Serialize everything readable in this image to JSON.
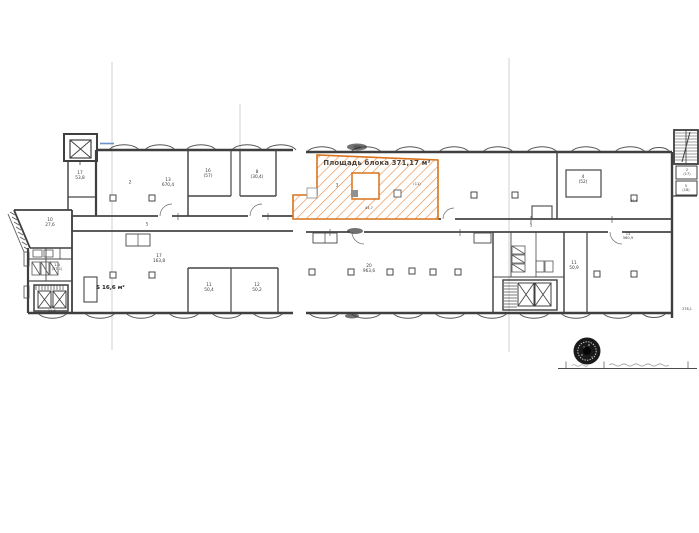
{
  "document": {
    "kind": "scanned floor plan sheet",
    "highlight_block": {
      "label": "Площадь блока 371,17 м²"
    },
    "annotations": {
      "s_area_label": "S 16,6 м²"
    }
  },
  "colors": {
    "wall_gray": "#3f3f3f",
    "highlight_border_orange": "#d9731c",
    "hatch_orange": "#e8853a",
    "crease_gray": "#d0d0d0",
    "blue_mark": "#6a93cc",
    "stamp_black": "#1a1a1a"
  },
  "icons": {
    "elevator_shaft": "x-box",
    "staircase": "step-hatch",
    "toilet_stall": "small-x-box",
    "column": "square-marker",
    "seal": "round-ink-stamp"
  },
  "rooms": [
    {
      "x": 80,
      "y": 177,
      "text": "17\n53,8"
    },
    {
      "x": 50,
      "y": 224,
      "text": "10\n27,6"
    },
    {
      "x": 57,
      "y": 267,
      "text": "1-4\n(57,1)",
      "size": 3.6
    },
    {
      "x": 52,
      "y": 309,
      "text": "1\n21,5",
      "size": 3.6
    },
    {
      "x": 130,
      "y": 184,
      "text": "2"
    },
    {
      "x": 168,
      "y": 184,
      "text": "13\n670,4"
    },
    {
      "x": 208,
      "y": 175,
      "text": "16\n(57)"
    },
    {
      "x": 257,
      "y": 176,
      "text": "8\n(30,4)"
    },
    {
      "x": 147,
      "y": 225,
      "text": "5",
      "size": 4
    },
    {
      "x": 159,
      "y": 260,
      "text": "17\n163,8"
    },
    {
      "x": 209,
      "y": 289,
      "text": "11\n50,4"
    },
    {
      "x": 257,
      "y": 289,
      "text": "12\n50,2"
    },
    {
      "x": 369,
      "y": 270,
      "text": "20\n963,6"
    },
    {
      "x": 531,
      "y": 226,
      "text": "5",
      "size": 4
    },
    {
      "x": 574,
      "y": 267,
      "text": "11\n50,9"
    },
    {
      "x": 628,
      "y": 236,
      "text": "13\n560,9",
      "size": 3.6
    },
    {
      "x": 583,
      "y": 181,
      "text": "4\n(52)"
    },
    {
      "x": 687,
      "y": 172,
      "text": "2\n(17)",
      "size": 3.5
    },
    {
      "x": 686,
      "y": 188,
      "text": "5\n(18)",
      "size": 3.5
    },
    {
      "x": 337,
      "y": 186,
      "text": "3",
      "size": 4
    },
    {
      "x": 417,
      "y": 184,
      "text": "(11)",
      "size": 3.6
    },
    {
      "x": 369,
      "y": 208,
      "text": "44,7",
      "size": 3.5
    },
    {
      "x": 687,
      "y": 310,
      "text": "278,1",
      "size": 3.4
    },
    {
      "x": 634,
      "y": 202,
      "text": "30,9",
      "size": 3.4
    }
  ],
  "stamp_block": {
    "seal_icon": "round-ink-seal",
    "signature_legible": false
  }
}
